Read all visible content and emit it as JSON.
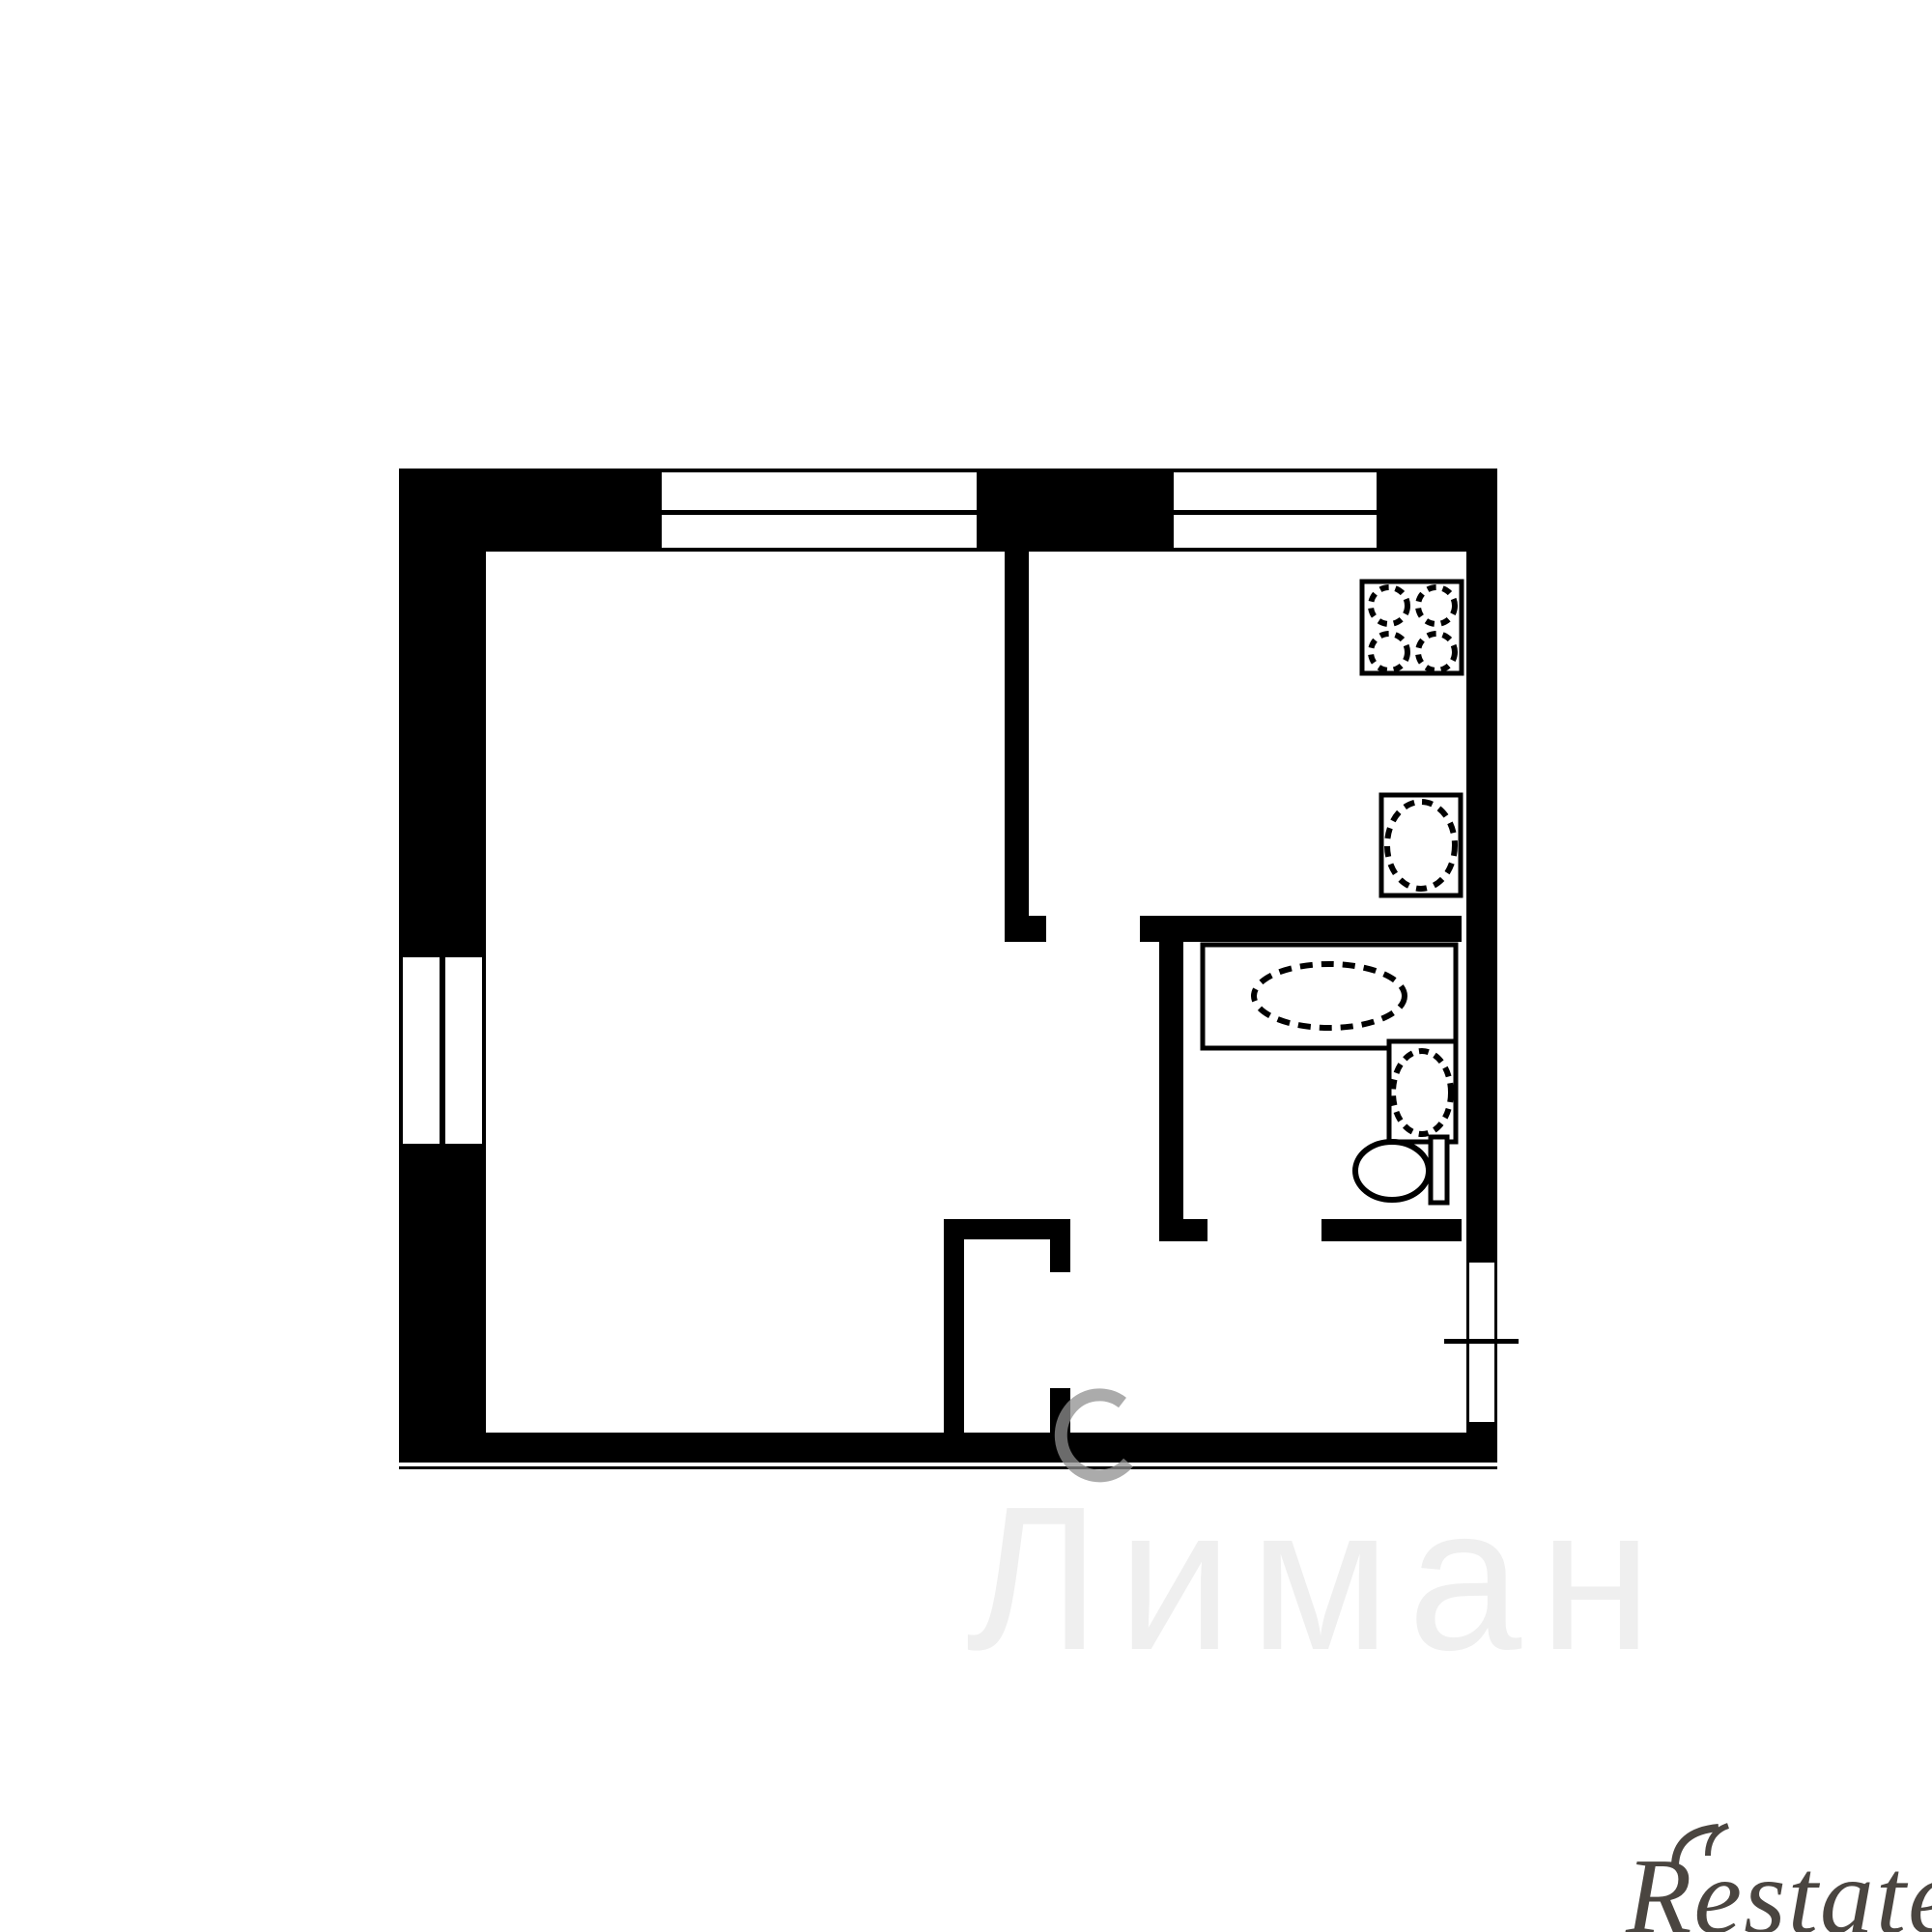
{
  "image": {
    "kind": "apartment floor plan scan",
    "background_color": "#ffffff",
    "wall_color": "#000000"
  },
  "floorplan": {
    "rooms": [
      "living-room",
      "kitchen",
      "bathroom",
      "hallway",
      "closet"
    ],
    "windows": [
      "top-wall-window-1",
      "top-wall-window-2",
      "left-wall-window"
    ],
    "fixtures": [
      "stove-icon",
      "kitchen-sink-icon",
      "bathtub-icon",
      "washbasin-icon",
      "toilet-icon"
    ],
    "door_marker": "+"
  },
  "watermarks": {
    "center": {
      "text": "Лиман",
      "color": "#efefef"
    },
    "fragment": {
      "color": "#8f8f8f"
    },
    "brand": {
      "text": "Restate",
      "color": "#4a4540"
    }
  }
}
